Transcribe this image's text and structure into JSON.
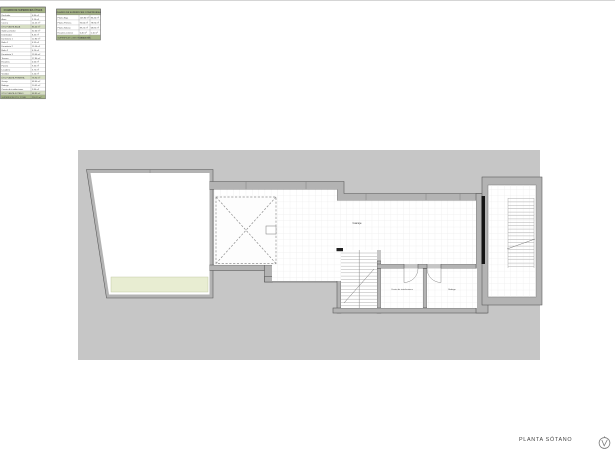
{
  "tables": {
    "useful": {
      "title": "CUADRO DE SUPERFICIES ÚTILES",
      "rows": [
        [
          "Recibidor",
          "6.80 m²",
          "normal"
        ],
        [
          "Aseo",
          "3.10 m²",
          "normal"
        ],
        [
          "Cocina",
          "14.25 m²",
          "normal"
        ],
        [
          "ÚTIL PLANTA BAJA",
          "86.40 m²",
          "section"
        ],
        [
          "Salón-comedor",
          "32.60 m²",
          "normal"
        ],
        [
          "Distribuidor",
          "8.45 m²",
          "normal"
        ],
        [
          "Dormitorio 1",
          "12.80 m²",
          "normal"
        ],
        [
          "Baño 1",
          "4.95 m²",
          "normal"
        ],
        [
          "Dormitorio 2",
          "11.60 m²",
          "normal"
        ],
        [
          "Baño 2",
          "4.20 m²",
          "normal"
        ],
        [
          "Dormitorio 3",
          "13.40 m²",
          "normal"
        ],
        [
          "Terraza",
          "17.80 m²",
          "normal"
        ],
        [
          "Escalera",
          "4.60 m²",
          "normal"
        ],
        [
          "Porche",
          "9.35 m²",
          "normal"
        ],
        [
          "Lavadero",
          "3.75 m²",
          "normal"
        ],
        [
          "Vestidor",
          "5.20 m²",
          "normal"
        ],
        [
          "ÚTIL PLANTA PRIMERA",
          "78.90 m²",
          "section"
        ],
        [
          "Garaje",
          "48.60 m²",
          "normal"
        ],
        [
          "Bodega",
          "10.45 m²",
          "normal"
        ],
        [
          "Cuarto de instalaciones",
          "9.80 m²",
          "normal"
        ],
        [
          "ÚTIL PLANTA SÓTANO",
          "68.85 m²",
          "section"
        ],
        [
          "SUPERFICIE ÚTIL TOTAL",
          "234.15 m²",
          "total"
        ]
      ]
    },
    "built": {
      "title": "CUADRO DE SUPERFICIES CONSTRUIDAS",
      "rows": [
        [
          "Planta Baja",
          "103.80 m²",
          "86.40 m²",
          "normal"
        ],
        [
          "Planta Primera",
          "95.60 m²",
          "78.90 m²",
          "normal"
        ],
        [
          "Planta Sótano",
          "89.25 m²",
          "68.85 m²",
          "normal"
        ],
        [
          "Escalera exterior",
          "6.40 m²",
          "5.10 m²",
          "normal"
        ],
        [
          "SUPERFICIE CONSTRUIDA TOTAL",
          "295.05 m²",
          "",
          "total"
        ]
      ]
    }
  },
  "plan": {
    "labels": {
      "garage": "Garaje",
      "utility": "Cuarto de instalaciones",
      "cellar": "Bodega"
    }
  },
  "footer": {
    "plan_title": "PLANTA SÓTANO"
  },
  "colors": {
    "header_green": "#a6b587",
    "section_green": "#d7dfc4",
    "row_white": "#ffffff",
    "sheet": "#c6c6c6",
    "wall": "#b3b3b3",
    "wall_line": "#555555",
    "floor_strip": "#e8edd2",
    "tile_line": "#e2e2e2",
    "label_gray": "#8a8a8a"
  }
}
